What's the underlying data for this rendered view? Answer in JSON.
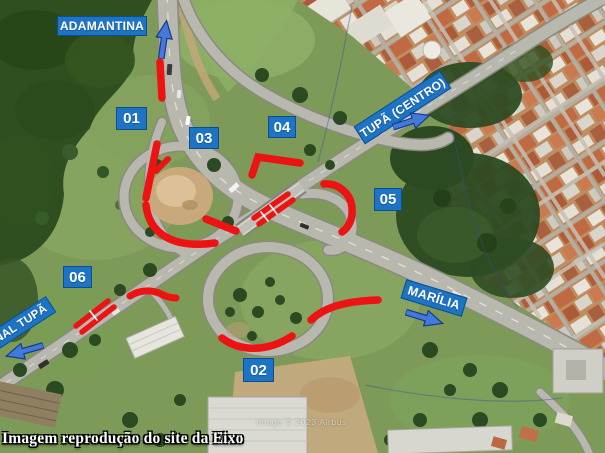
{
  "figure": {
    "caption": "Imagem reprodução do site da Eixo",
    "watermark": "Image © 2023 Airbus"
  },
  "colors": {
    "label_blue": "#1e74c4",
    "label_border": "#0d4f8e",
    "marker_red": "#ee1313",
    "arrow_fill": "#4479d9",
    "arrow_border": "#133a8c"
  },
  "destinations": {
    "north": "ADAMANTINA",
    "northeast": "TUPÃ (CENTRO)",
    "east": "MARÍLIA",
    "southwest": "NAL TUPÃ"
  },
  "markers": [
    "01",
    "02",
    "03",
    "04",
    "05",
    "06"
  ]
}
